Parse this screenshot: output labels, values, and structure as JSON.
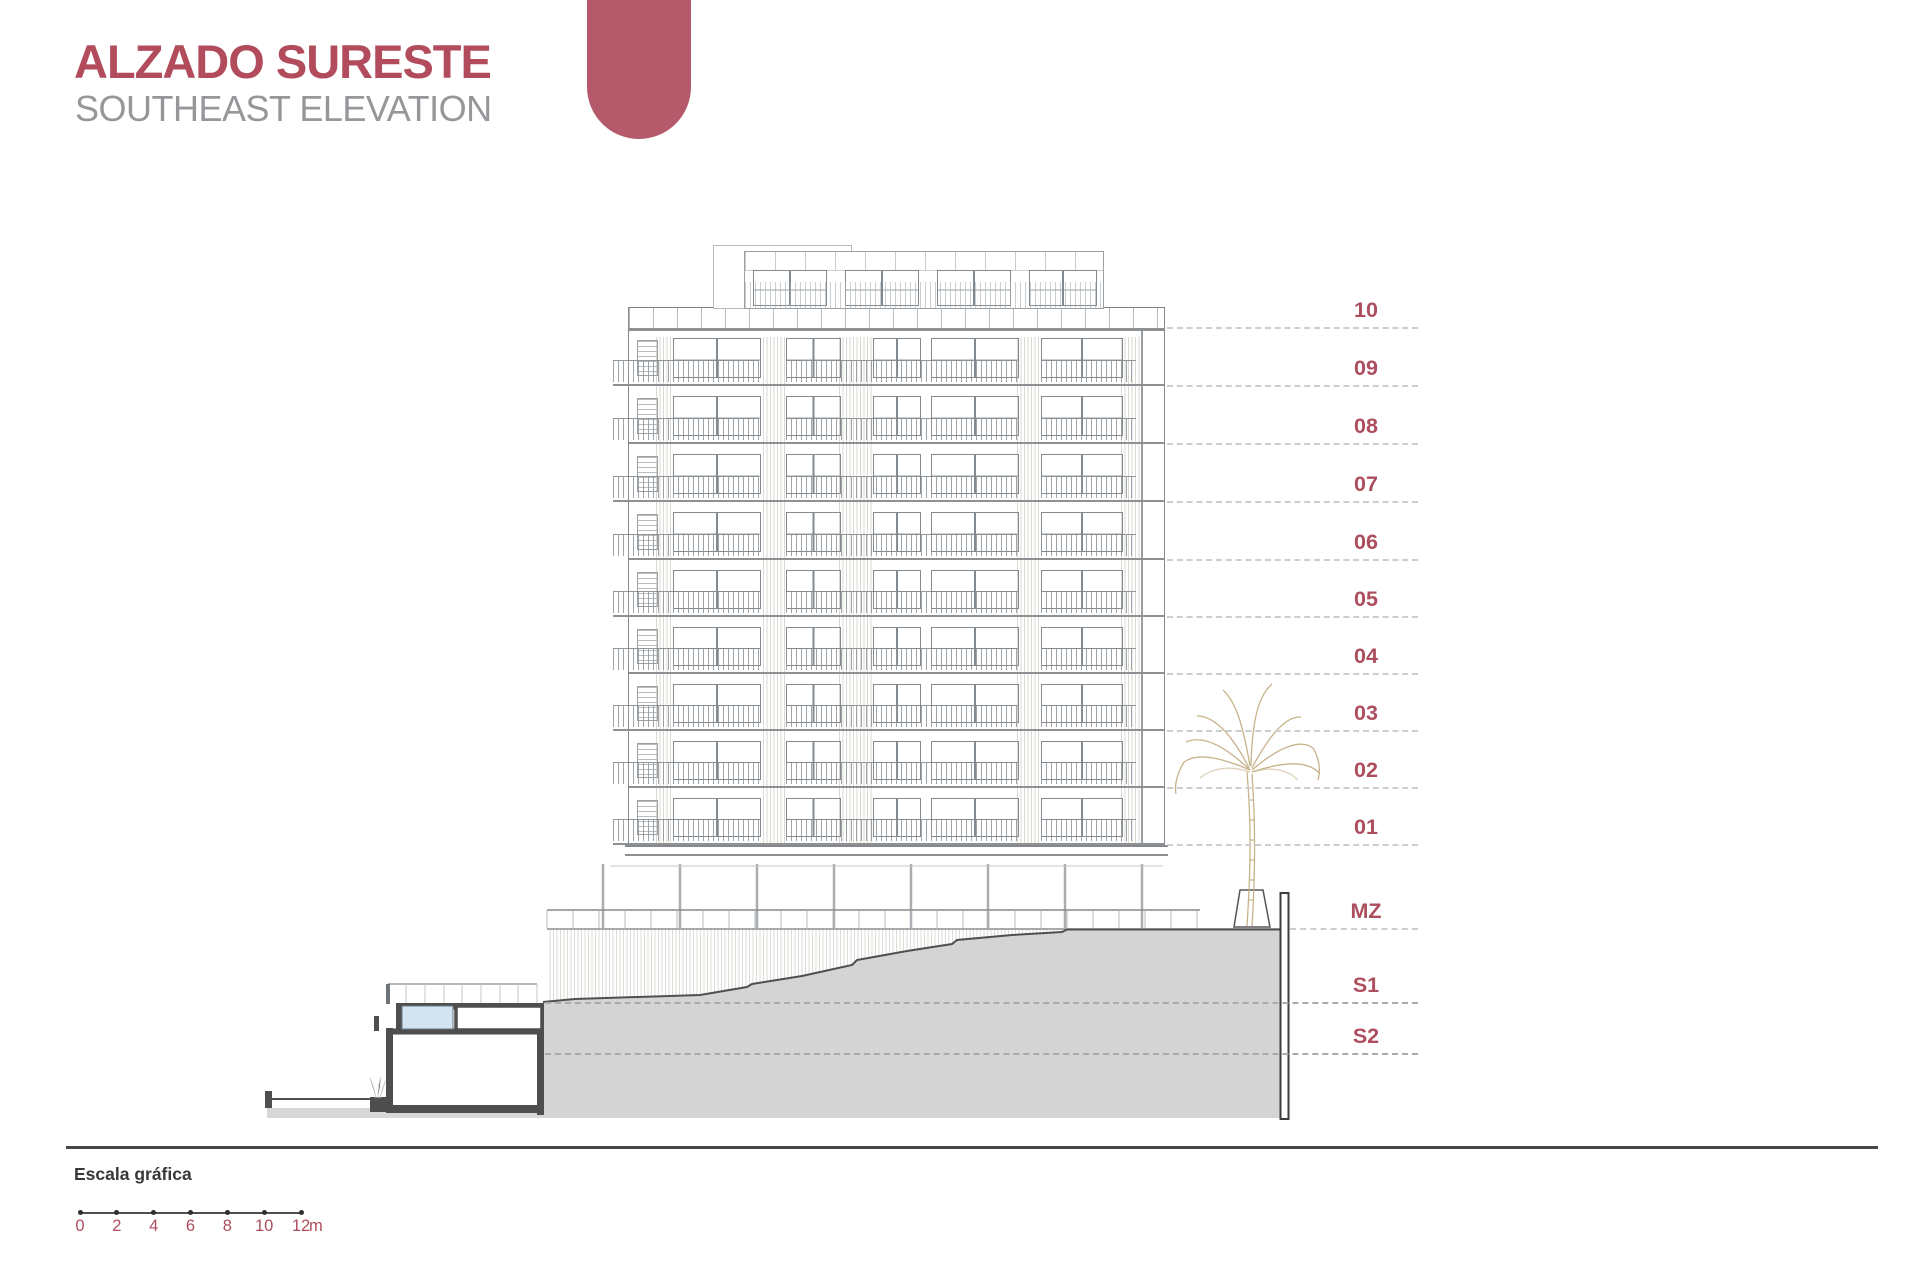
{
  "header": {
    "title": "ALZADO SURESTE",
    "subtitle": "SOUTHEAST ELEVATION"
  },
  "levels": {
    "labels": [
      "10",
      "09",
      "08",
      "07",
      "06",
      "05",
      "04",
      "03",
      "02",
      "01",
      "MZ",
      "S1",
      "S2"
    ]
  },
  "scale_bar": {
    "heading": "Escala gráfica",
    "ticks": [
      "0",
      "2",
      "4",
      "6",
      "8",
      "10",
      "12"
    ],
    "unit": "m"
  },
  "colors": {
    "title_accent": "#b24c5c",
    "badge": "#b45a6a",
    "subtitle_gray": "#95979a",
    "level_label": "#ad4e5e",
    "dash_line": "#cbcdce",
    "terrain_gray": "#d4d4d4",
    "section_dark": "#4e4e4e",
    "pool_blue": "#d2e3f2",
    "palm_tan": "#c2ab7e",
    "drawing_line": "#8b9094"
  }
}
